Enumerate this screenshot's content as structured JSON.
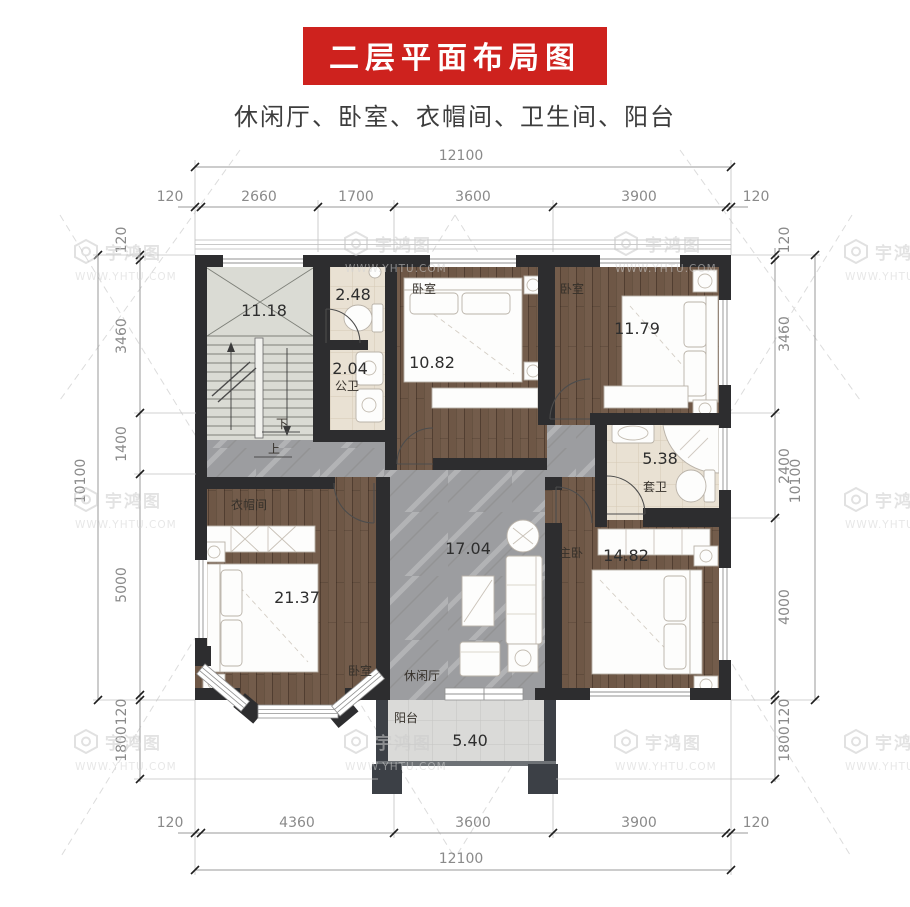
{
  "header": {
    "title": "二层平面布局图",
    "subtitle": "休闲厅、卧室、衣帽间、卫生间、阳台",
    "banner_color": "#ce221e"
  },
  "watermark": {
    "brand": "宇鸿图",
    "site": "WWW.YHTU.COM"
  },
  "dimensions": {
    "top": {
      "overall": "12100",
      "segments": [
        "120",
        "2660",
        "1700",
        "3600",
        "3900",
        "120"
      ]
    },
    "bottom": {
      "overall": "12100",
      "segments": [
        "120",
        "4360",
        "3600",
        "3900",
        "120"
      ]
    },
    "left": {
      "overall": "10100",
      "segments": [
        "120",
        "3460",
        "1400",
        "5000",
        "120",
        "1800"
      ]
    },
    "right": {
      "overall": "10100",
      "segments": [
        "120",
        "3460",
        "2400",
        "4000",
        "120",
        "1800"
      ]
    }
  },
  "rooms": {
    "stairwell": {
      "area": "11.18",
      "down_label": "下",
      "up_label": "上"
    },
    "wc_upper": {
      "area": "2.48"
    },
    "wc_lower": {
      "area": "2.04",
      "name": "公卫"
    },
    "bedroom_a": {
      "name": "卧室",
      "area": "10.82"
    },
    "bedroom_b": {
      "name": "卧室",
      "area": "11.79"
    },
    "ensuite": {
      "name": "套卫",
      "area": "5.38"
    },
    "lounge": {
      "name": "休闲厅",
      "area": "17.04"
    },
    "master": {
      "name": "主卧",
      "area": "14.82"
    },
    "cloakroom": {
      "name": "衣帽间"
    },
    "bedroom_c": {
      "name": "卧室",
      "area": "21.37"
    },
    "balcony": {
      "name": "阳台",
      "area": "5.40"
    }
  },
  "colors": {
    "wall": "#2d2d2f",
    "wood": "#6e5746",
    "marble": "#9c9da0",
    "bath_tile": "#e9e1d3",
    "balcony_tile": "#dadad8"
  }
}
